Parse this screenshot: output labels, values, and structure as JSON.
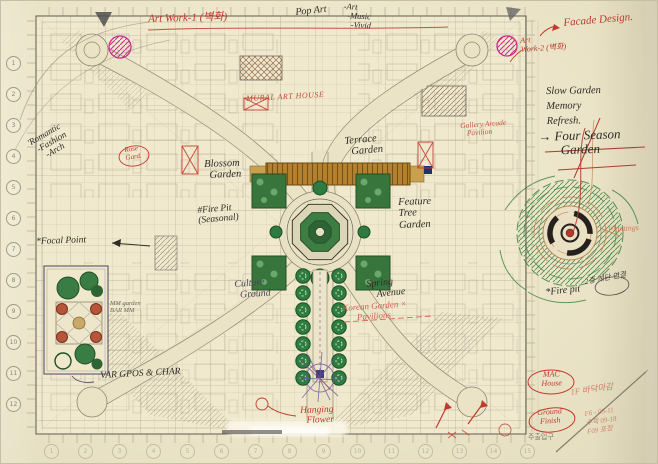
{
  "palette": {
    "paper": "#ece5c9",
    "red_ink": "#c0392b",
    "magenta": "#cc2b8e",
    "ink": "#2f2b26",
    "pencil": "#7a7262",
    "green": "#2f7a3f",
    "terrace_brown": "#b5812e",
    "purple": "#6a4fa0",
    "orange": "#c77f4f"
  },
  "annotations": {
    "art_work_1": "Art Work-1 (벽화)",
    "pop_art": "Pop Art",
    "pop_list": [
      "-Art",
      "-Music",
      "-Vivid"
    ],
    "facade_design": "Facade Design.",
    "art_work_2": [
      "Art",
      "Work-2 (벽화)"
    ],
    "slow_garden": [
      "Slow Garden",
      "Memory",
      "Refresh."
    ],
    "four_season": [
      "→ Four Season",
      "Garden"
    ],
    "mural_art_house": "MURAL ART HOUSE",
    "gallery": [
      "Gallery Arcade",
      "Pavilion"
    ],
    "rose_garden": [
      "Rose",
      "Gard."
    ],
    "terrace_garden": [
      "Terrace",
      "Garden"
    ],
    "feature_tree_garden": [
      "Feature",
      "Tree",
      "Garden"
    ],
    "blossom_garden": [
      "Blossom",
      "Garden"
    ],
    "fire_pit_west": [
      "#Fire Pit",
      "(Seasonal)"
    ],
    "culture_ground": [
      "Culture",
      "Ground"
    ],
    "spring_avenue": [
      "Spring",
      "Avenue"
    ],
    "korean_pavilions": [
      "Korean Garden ×",
      "Pavilions"
    ],
    "romantic": [
      "'Romantic",
      "-Fashion",
      "-Arch"
    ],
    "focal_point": "*Focal Point",
    "fire_pit_east": "*Fire pit",
    "plantings": "Plantings",
    "floor_link": "2층 계단 연결",
    "hanging_flower": [
      "Hanging",
      "Flower"
    ],
    "mac_house": [
      "MAC",
      "House"
    ],
    "ground_finish": [
      "Ground",
      "Finish"
    ],
    "floor_finish": "1F 바닥마감",
    "red_notes": [
      "F6 - 05-11",
      "수목 09-18",
      "F09 포장"
    ],
    "var_chairs": "VAR GPOS & CHAR",
    "mm_garden": [
      "MM garden",
      "BAR MM"
    ],
    "main_entrance": "주출입구"
  },
  "grid": {
    "left_bubbles": [
      "1",
      "2",
      "3",
      "4",
      "5",
      "6",
      "7",
      "8",
      "9",
      "10",
      "11",
      "12"
    ],
    "bottom_bubbles": [
      "1",
      "2",
      "3",
      "4",
      "5",
      "6",
      "7",
      "8",
      "9",
      "10",
      "11",
      "12",
      "13",
      "14",
      "15"
    ]
  }
}
